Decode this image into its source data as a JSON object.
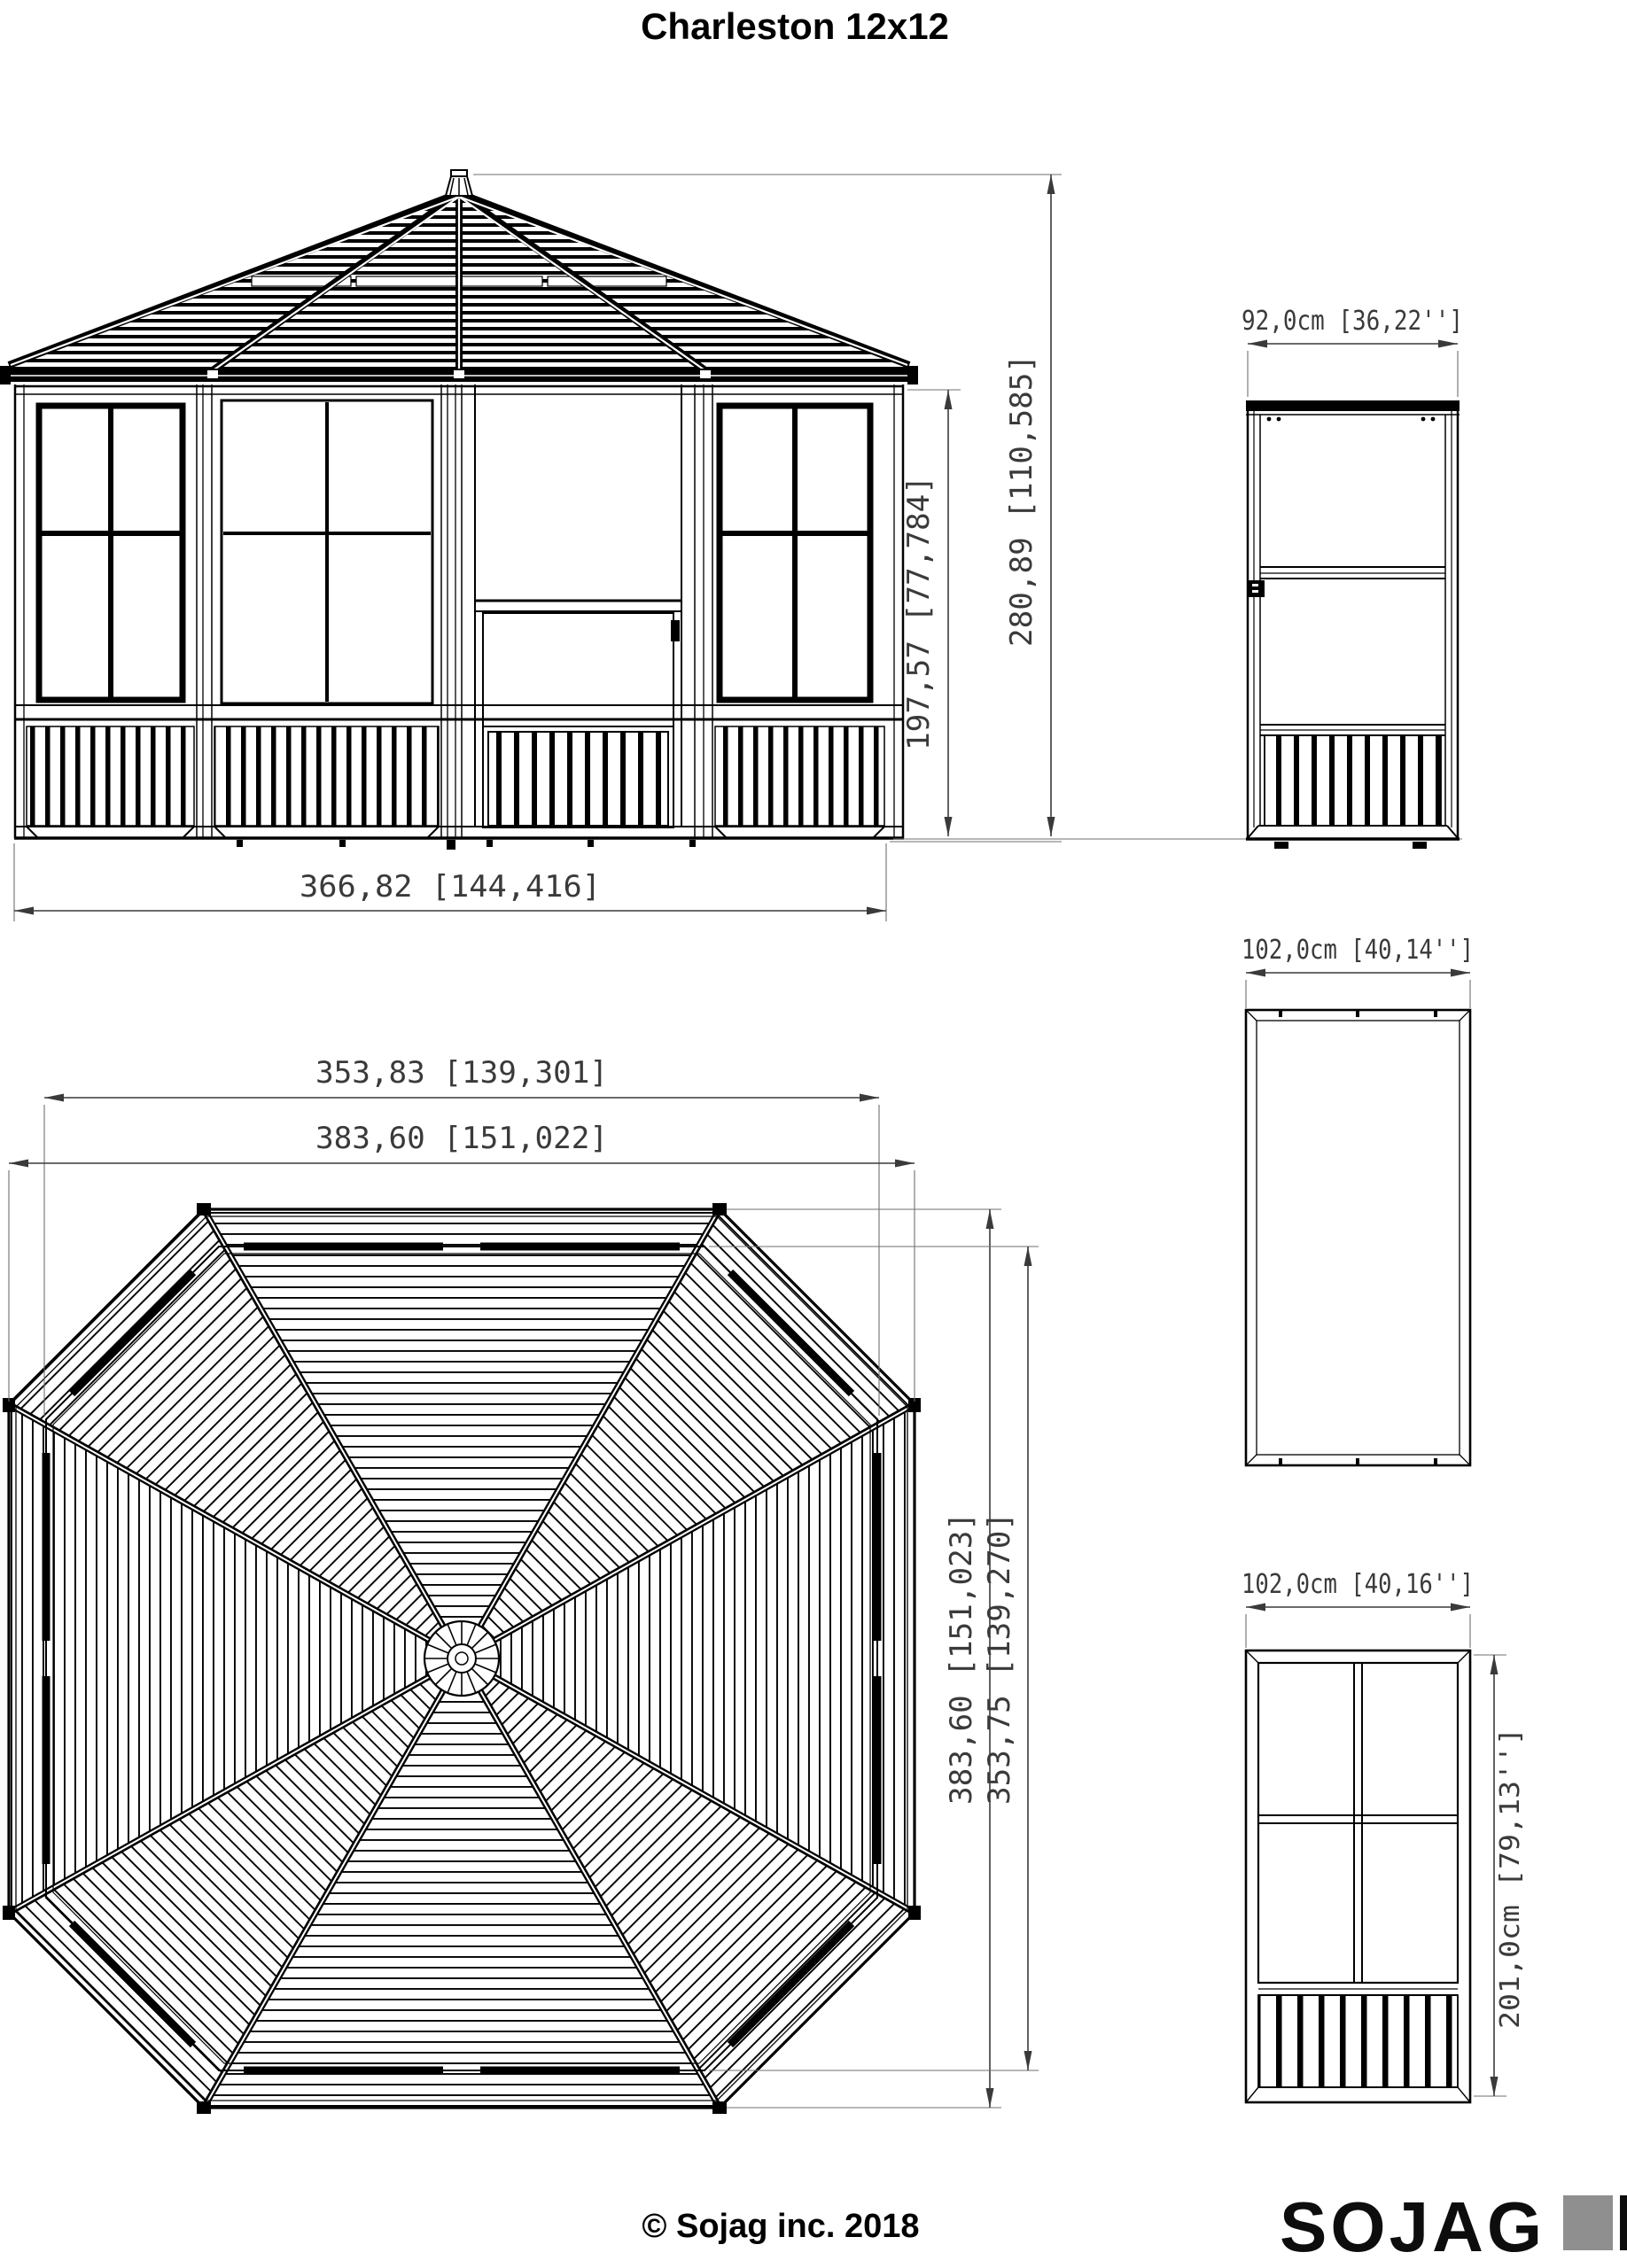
{
  "title": "Charleston 12x12",
  "front_elevation": {
    "dim_width": "366,82 [144,416]",
    "dim_wall_height": "197,57 [77,784]",
    "dim_total_height": "280,89 [110,585]"
  },
  "plan_view": {
    "dim_width_inner": "353,83 [139,301]",
    "dim_width_outer": "383,60 [151,022]",
    "dim_height_outer": "383,60 [151,023]",
    "dim_height_inner": "353,75 [139,270]"
  },
  "door_panel": {
    "dim_width": "92,0cm [36,22'']"
  },
  "roof_panel": {
    "dim_width": "102,0cm [40,14'']"
  },
  "wall_panel": {
    "dim_width": "102,0cm [40,16'']",
    "dim_height": "201,0cm [79,13'']"
  },
  "footer": {
    "copyright": "© Sojag inc. 2018",
    "brand": "SOJAG"
  }
}
